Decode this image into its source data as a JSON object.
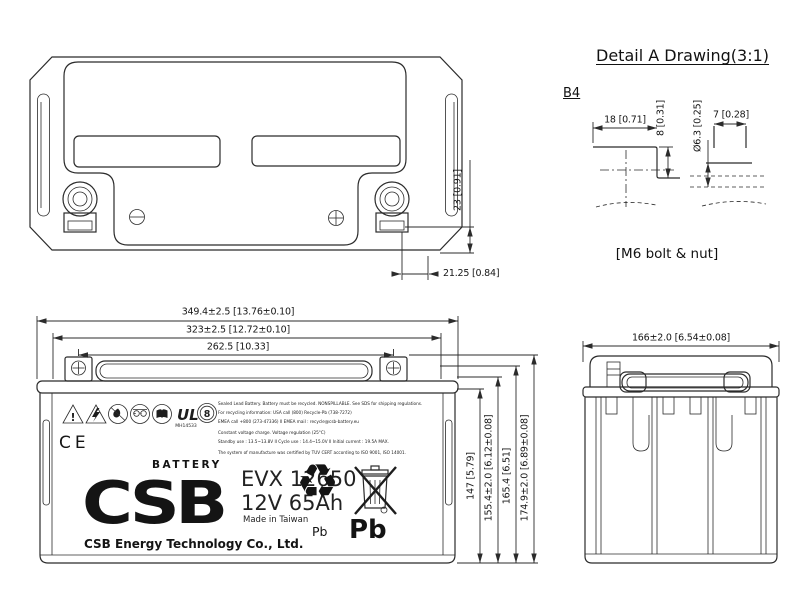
{
  "colors": {
    "background": "#ffffff",
    "line": "#2b2b2b",
    "text": "#161616"
  },
  "detail_a": {
    "title": "Detail A Drawing(3:1)",
    "ref_label": "B4",
    "dim_flat_width": "18 [0.71]",
    "dim_step_height": "8 [0.31]",
    "dim_bolt_diameter": "Ø6.3 [0.25]",
    "dim_nut_height": "7 [0.28]",
    "caption": "[M6 bolt & nut]"
  },
  "top_view": {
    "dim_terminal_height": "23 [0.91]",
    "dim_terminal_offset": "21.25 [0.84]"
  },
  "front_view": {
    "dim_overall_length": "349.4±2.5 [13.76±0.10]",
    "dim_case_length": "323±2.5 [12.72±0.10]",
    "dim_terminal_pitch": "262.5 [10.33]",
    "dim_height_case": "147 [5.79]",
    "dim_height_lid": "155.4±2.0 [6.12±0.08]",
    "dim_height_handle": "165.4 [6.51]",
    "dim_height_total": "174.9±2.0 [6.89±0.08]"
  },
  "side_view": {
    "dim_width": "166±2.0 [6.54±0.08]"
  },
  "label": {
    "brand": "CSB",
    "brand_sub": "BATTERY",
    "model": "EVX 12650",
    "rating": "12V 65Ah",
    "origin": "Made in Taiwan",
    "company": "CSB Energy Technology Co., Ltd.",
    "ce_mark": "CE",
    "ul_mark": "UL",
    "ul_code": "MH14533",
    "rohs_number": "8",
    "warning_exclamation": "!",
    "recycle_symbol": "♻",
    "pb_recycle": "Pb",
    "pb_bin": "Pb",
    "fine_print": [
      "Sealed Lead Battery. Battery must be recycled. NONSPILLABLE. See SDS for shipping regulations.",
      "For recycling information: USA call (800) Recycle-Pb (738-7272)",
      "EMEA call +800 (273-47336)  II  EMEA mail : recycle@csb-battery.eu",
      "Constant voltage charge. Voltage regulation (25°C)",
      "Standby use : 13.5~13.8V  II  Cycle use : 14.4~15.0V  II  Initial current : 19.5A MAX.",
      "The system of manufacture was certified by TUV CERT according to ISO 9001, ISO 14001."
    ],
    "safety_icon_names": [
      "warning-triangle-icon",
      "electric-hazard-triangle-icon",
      "no-fire-circle-icon",
      "eye-protection-circle-icon",
      "read-manual-circle-icon",
      "ul-mark-icon",
      "rohs-circle-8-icon"
    ]
  }
}
